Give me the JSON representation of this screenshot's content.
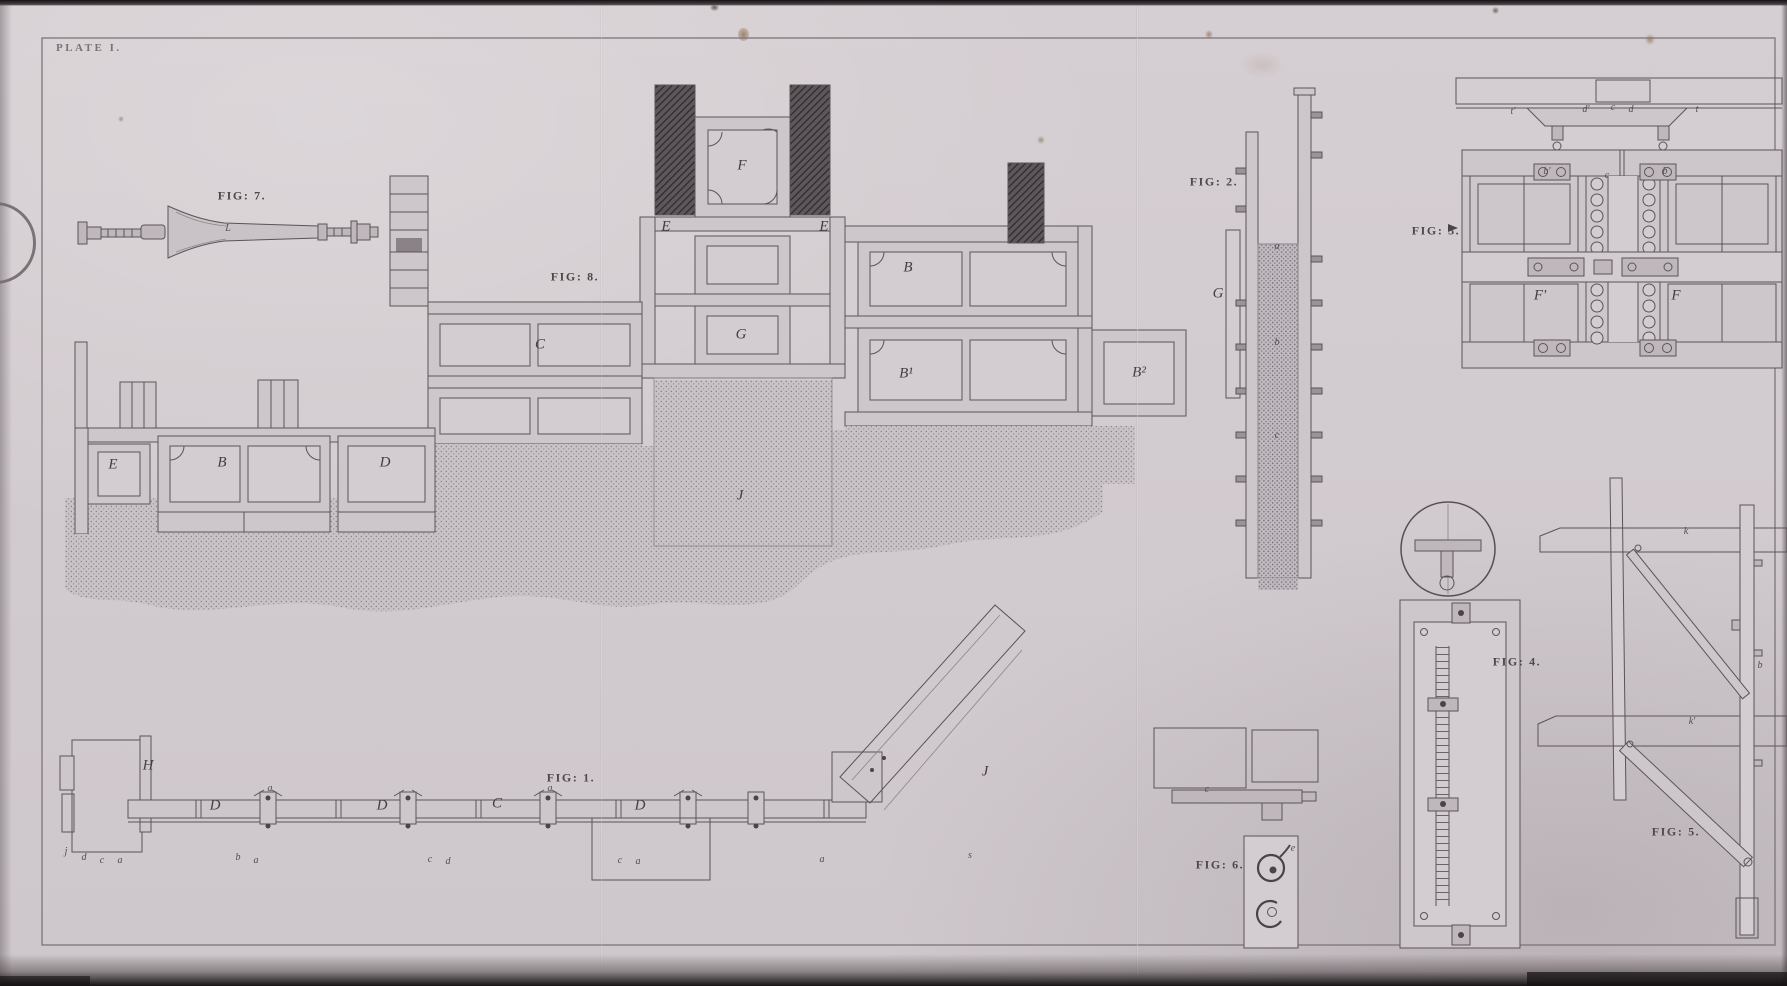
{
  "plate": {
    "title": "PLATE I.",
    "figure_labels": {
      "fig1": "FIG: 1.",
      "fig2": "FIG: 2.",
      "fig3": "FIG: 3.",
      "fig4": "FIG: 4.",
      "fig5": "FIG: 5.",
      "fig6": "FIG: 6.",
      "fig7": "FIG: 7.",
      "fig8": "FIG: 8."
    }
  },
  "fig8": {
    "letters": {
      "f": "F",
      "e_left": "E",
      "e_right": "E",
      "b": "B",
      "g": "G",
      "c": "C",
      "b1": "B¹",
      "b2": "B²",
      "j": "J",
      "e_wing": "E",
      "b_wing": "B",
      "d_wing": "D"
    }
  },
  "fig1": {
    "letters": {
      "h": "H",
      "d1": "D",
      "d2": "D",
      "c": "C",
      "d3": "D",
      "j": "J"
    },
    "ticks": [
      {
        "t": "j"
      },
      {
        "t": "d"
      },
      {
        "t": "c"
      },
      {
        "t": "a"
      },
      {
        "t": "b"
      },
      {
        "t": "a"
      },
      {
        "t": "c"
      },
      {
        "t": "d"
      },
      {
        "t": "c"
      },
      {
        "t": "a"
      },
      {
        "t": "a"
      },
      {
        "t": "s"
      },
      {
        "t": "a"
      },
      {
        "t": "a"
      }
    ]
  },
  "fig2": {
    "letters": {
      "g": "G",
      "a": "a",
      "b": "b",
      "c": "c"
    }
  },
  "fig3": {
    "letters": {
      "t1": "t'",
      "d1": "d'",
      "c1": "c",
      "d2": "d",
      "t2": "t",
      "b1": "b'",
      "c2": "c",
      "b2": "b",
      "f1": "F'",
      "f2": "F"
    }
  },
  "fig5": {
    "letters": {
      "k": "k",
      "k2": "k'",
      "b": "b"
    }
  },
  "fig6": {
    "letters": {
      "e": "e",
      "c": "c"
    }
  },
  "fig7": {
    "letters": {
      "l": "L"
    }
  }
}
